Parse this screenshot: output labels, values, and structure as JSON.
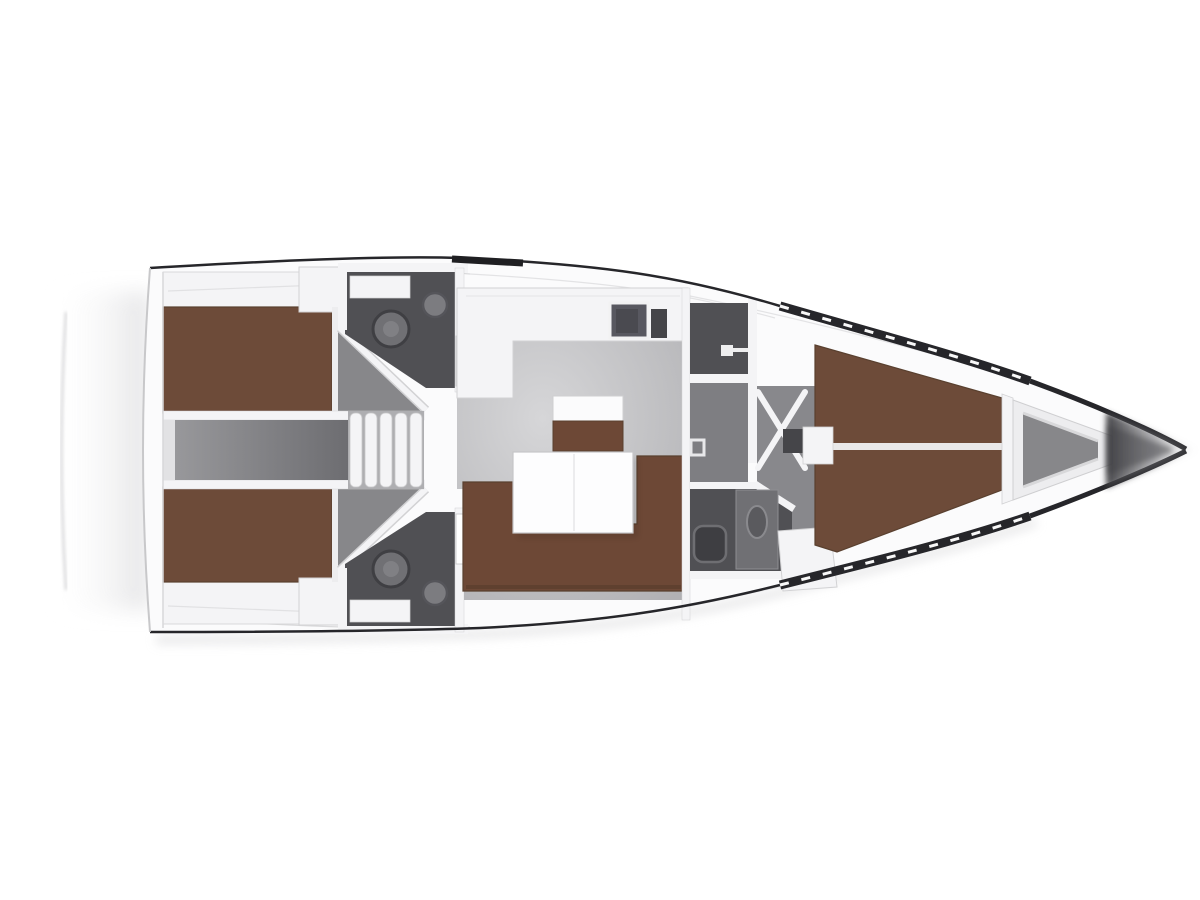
{
  "image": {
    "kind": "yacht-interior-floorplan",
    "orientation": "bow-right"
  },
  "colors": {
    "background": "#ffffff",
    "hull_line": "#26262a",
    "deck": "#fbfbfc",
    "wall": "#f4f4f6",
    "wall_edge": "#d2d2d4",
    "salon_floor_light": "#d6d6d8",
    "salon_floor": "#b1b1b4",
    "corridor_floor": "#7e7e82",
    "engine_floor_light": "#9b9b9e",
    "engine_floor_dark": "#6d6d71",
    "head_floor": "#505054",
    "wedge_floor": "#87878a",
    "berth": "#6d4b39",
    "berth_edge": "#59402f",
    "sofa": "#6d4836",
    "table": "#fdfdfe",
    "sideboard_top": "#fbfbfc",
    "fixture": "#707074",
    "fixture_dark": "#454549",
    "sink": "#585860",
    "stairs_base": "#aeaeb1",
    "bow_shadow": "#3c3c40",
    "soft_shadow": "#dedee0"
  },
  "components": {
    "rooms": [
      {
        "name": "aft-cabin-port",
        "kind": "double-berth-cabin"
      },
      {
        "name": "aft-cabin-starboard",
        "kind": "double-berth-cabin"
      },
      {
        "name": "aft-head-port",
        "kind": "bathroom"
      },
      {
        "name": "aft-head-starboard",
        "kind": "bathroom"
      },
      {
        "name": "engine-compartment",
        "kind": "corridor"
      },
      {
        "name": "companionway-stairs",
        "kind": "stairs"
      },
      {
        "name": "galley",
        "kind": "kitchen-counter"
      },
      {
        "name": "salon",
        "kind": "seating-area"
      },
      {
        "name": "fore-head",
        "kind": "bathroom"
      },
      {
        "name": "shower-room",
        "kind": "bathroom"
      },
      {
        "name": "forward-cabin",
        "kind": "v-berth-cabin"
      },
      {
        "name": "anchor-locker",
        "kind": "bow-storage"
      }
    ],
    "fixtures": [
      "toilet",
      "wash-basin",
      "galley-sink",
      "salon-table",
      "l-shaped-sofa",
      "sideboard",
      "door-swing",
      "stair-treads",
      "berth-mattress",
      "shower-column"
    ]
  }
}
